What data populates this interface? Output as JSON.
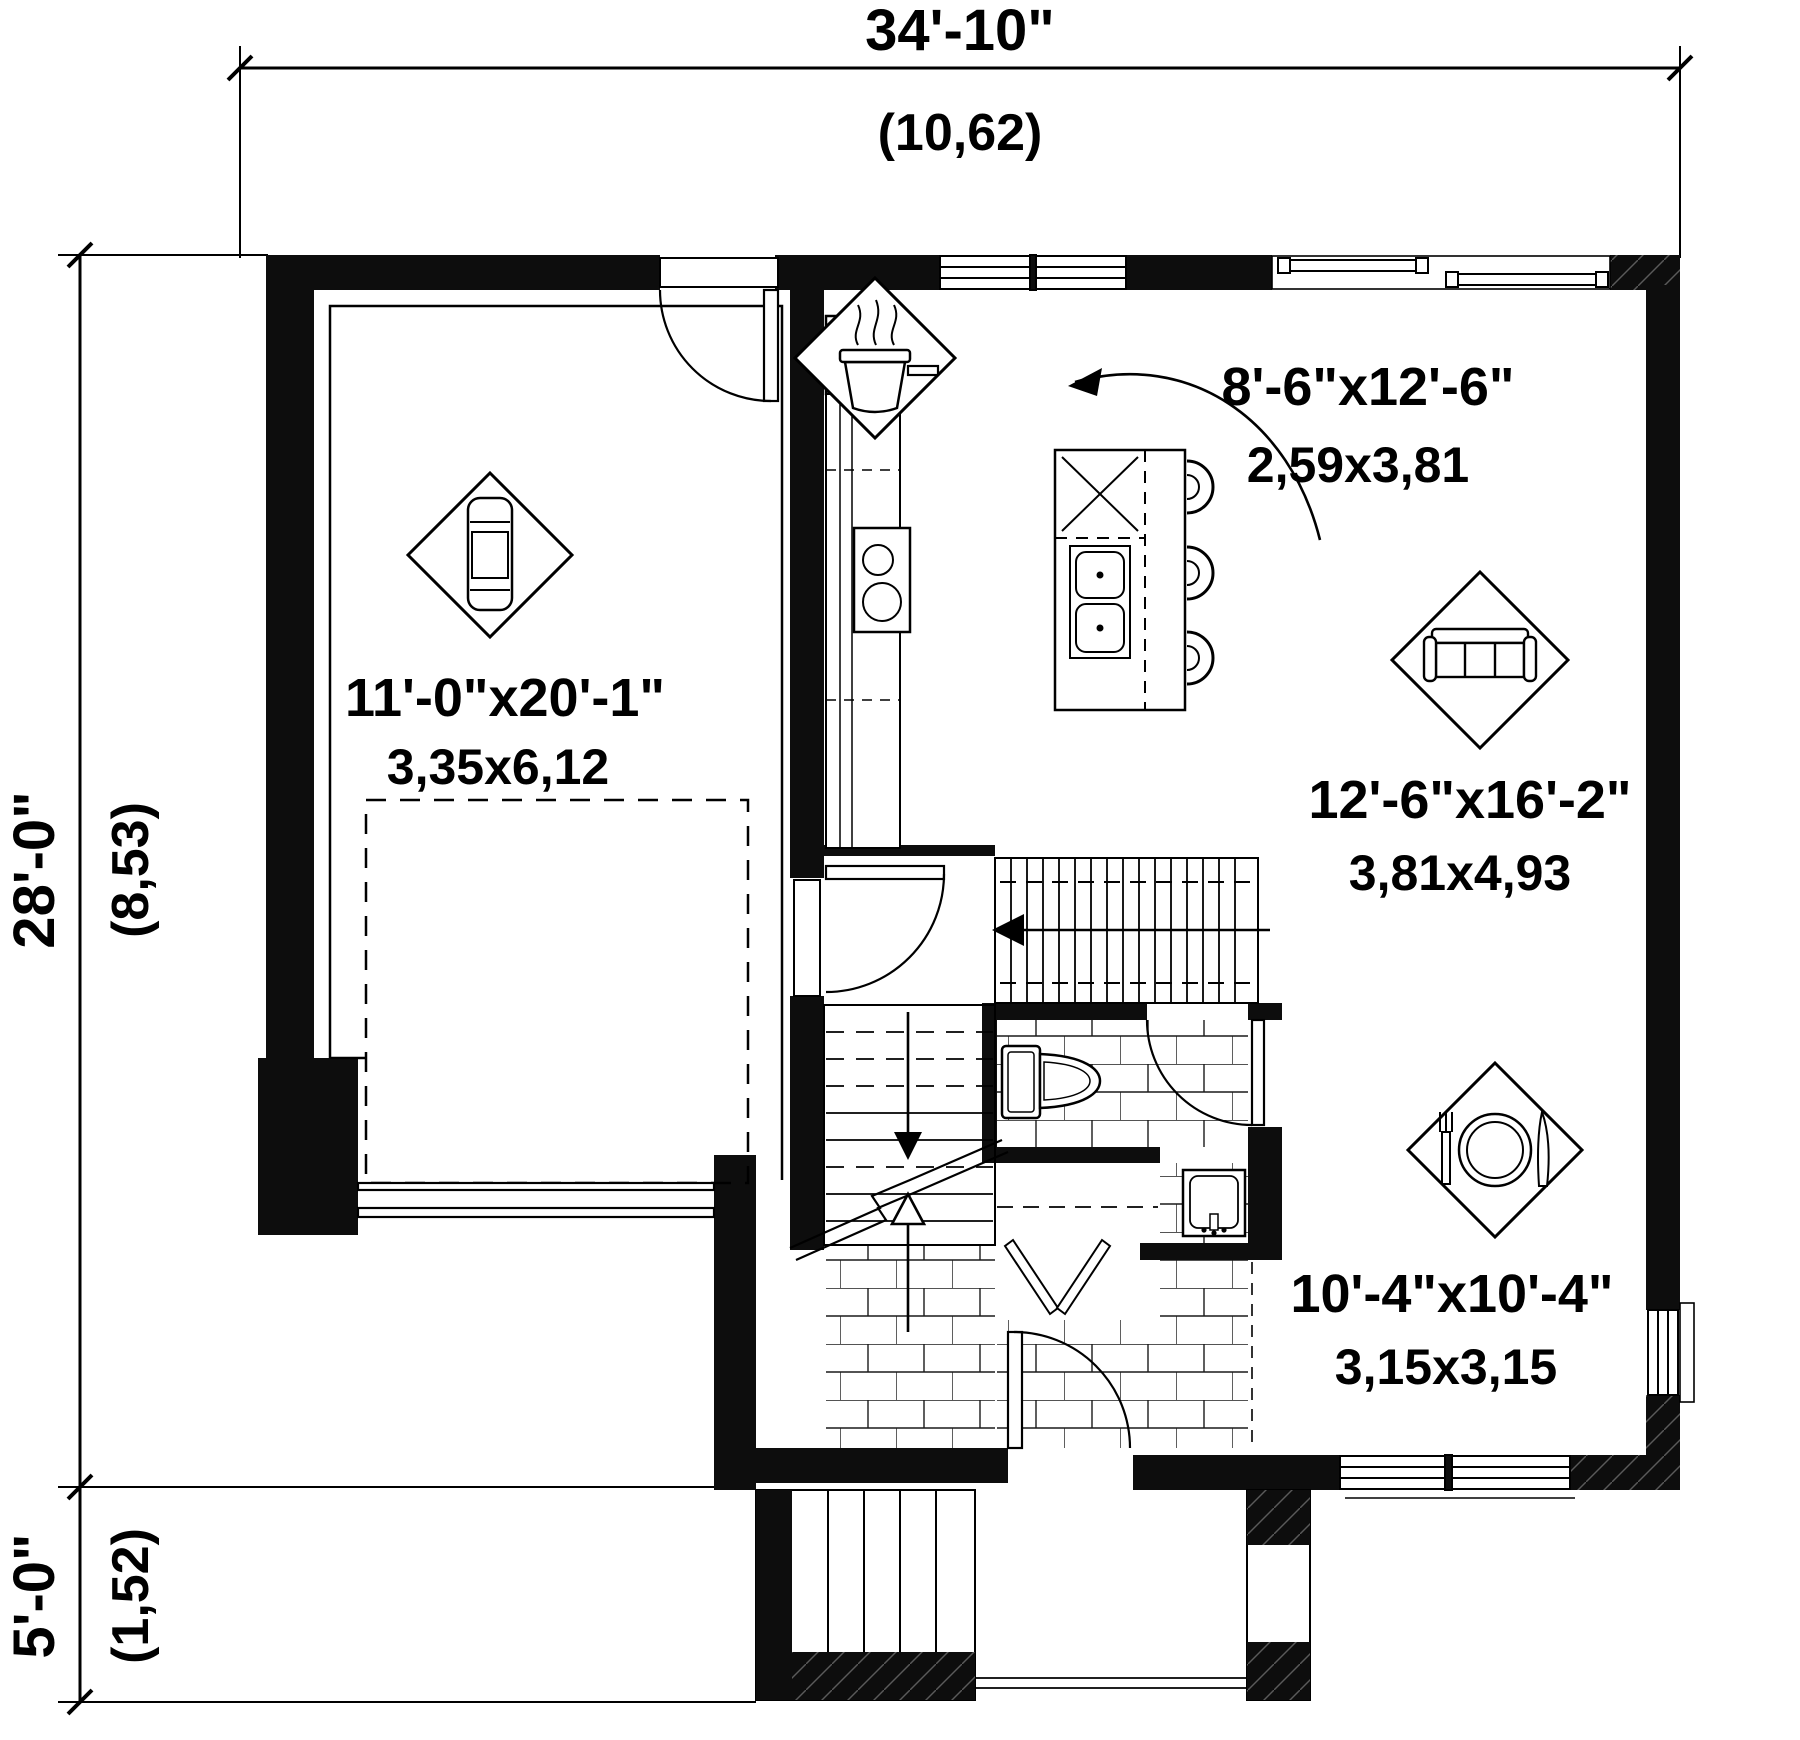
{
  "dimensions": {
    "overall_width": {
      "feet": "34'-10\"",
      "meters": "(10,62)"
    },
    "overall_depth": {
      "feet": "28'-0\"",
      "meters": "(8,53)"
    },
    "porch_depth": {
      "feet": "5'-0\"",
      "meters": "(1,52)"
    }
  },
  "rooms": {
    "garage": {
      "size_feet": "11'-0\"x20'-1\"",
      "size_meters": "3,35x6,12",
      "icon": "car-icon"
    },
    "kitchen": {
      "size_feet": "8'-6\"x12'-6\"",
      "size_meters": "2,59x3,81",
      "icon": "cooking-pot-icon"
    },
    "living_room": {
      "size_feet": "12'-6\"x16'-2\"",
      "size_meters": "3,81x4,93",
      "icon": "sofa-icon"
    },
    "dining_room": {
      "size_feet": "10'-4\"x10'-4\"",
      "size_meters": "3,15x3,15",
      "icon": "dining-place-setting-icon"
    }
  },
  "colors": {
    "wall": "#0d0d0d",
    "line": "#000000",
    "background": "#ffffff"
  }
}
